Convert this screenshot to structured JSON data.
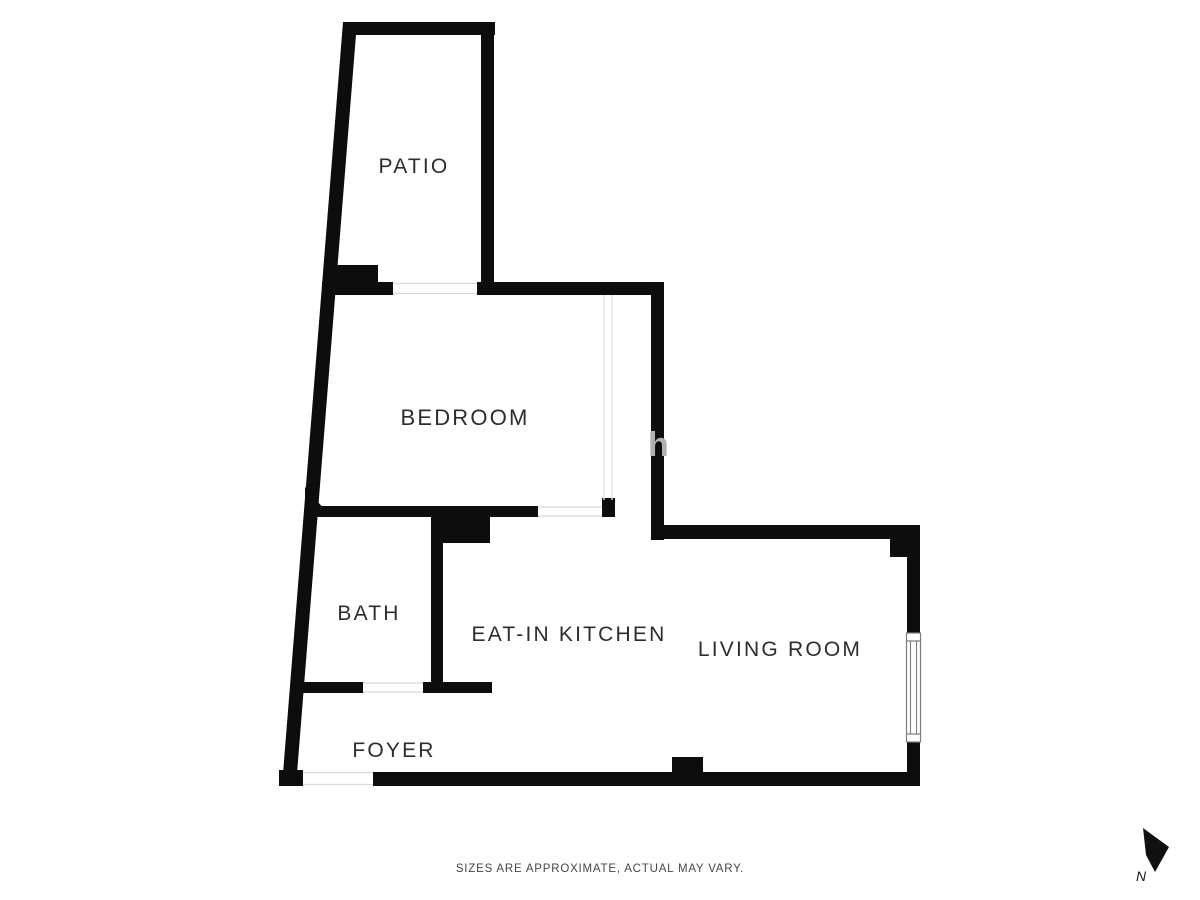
{
  "rooms": {
    "patio": "PATIO",
    "bedroom": "BEDROOM",
    "bath": "BATH",
    "kitchen": "EAT-IN KITCHEN",
    "living": "LIVING ROOM",
    "foyer": "FOYER"
  },
  "footer": {
    "disclaimer": "SIZES ARE APPROXIMATE, ACTUAL MAY VARY."
  },
  "compass": {
    "label": "N"
  },
  "watermark": {
    "text": "h"
  },
  "colors": {
    "wall": "#0d0d0d",
    "label_text": "#2d2d2d",
    "opening_line": "#d8d8d8",
    "glass_line": "#e2e2e2",
    "window_frame": "#7d7d7d",
    "watermark": "#b0b0b0",
    "background": "#ffffff"
  }
}
